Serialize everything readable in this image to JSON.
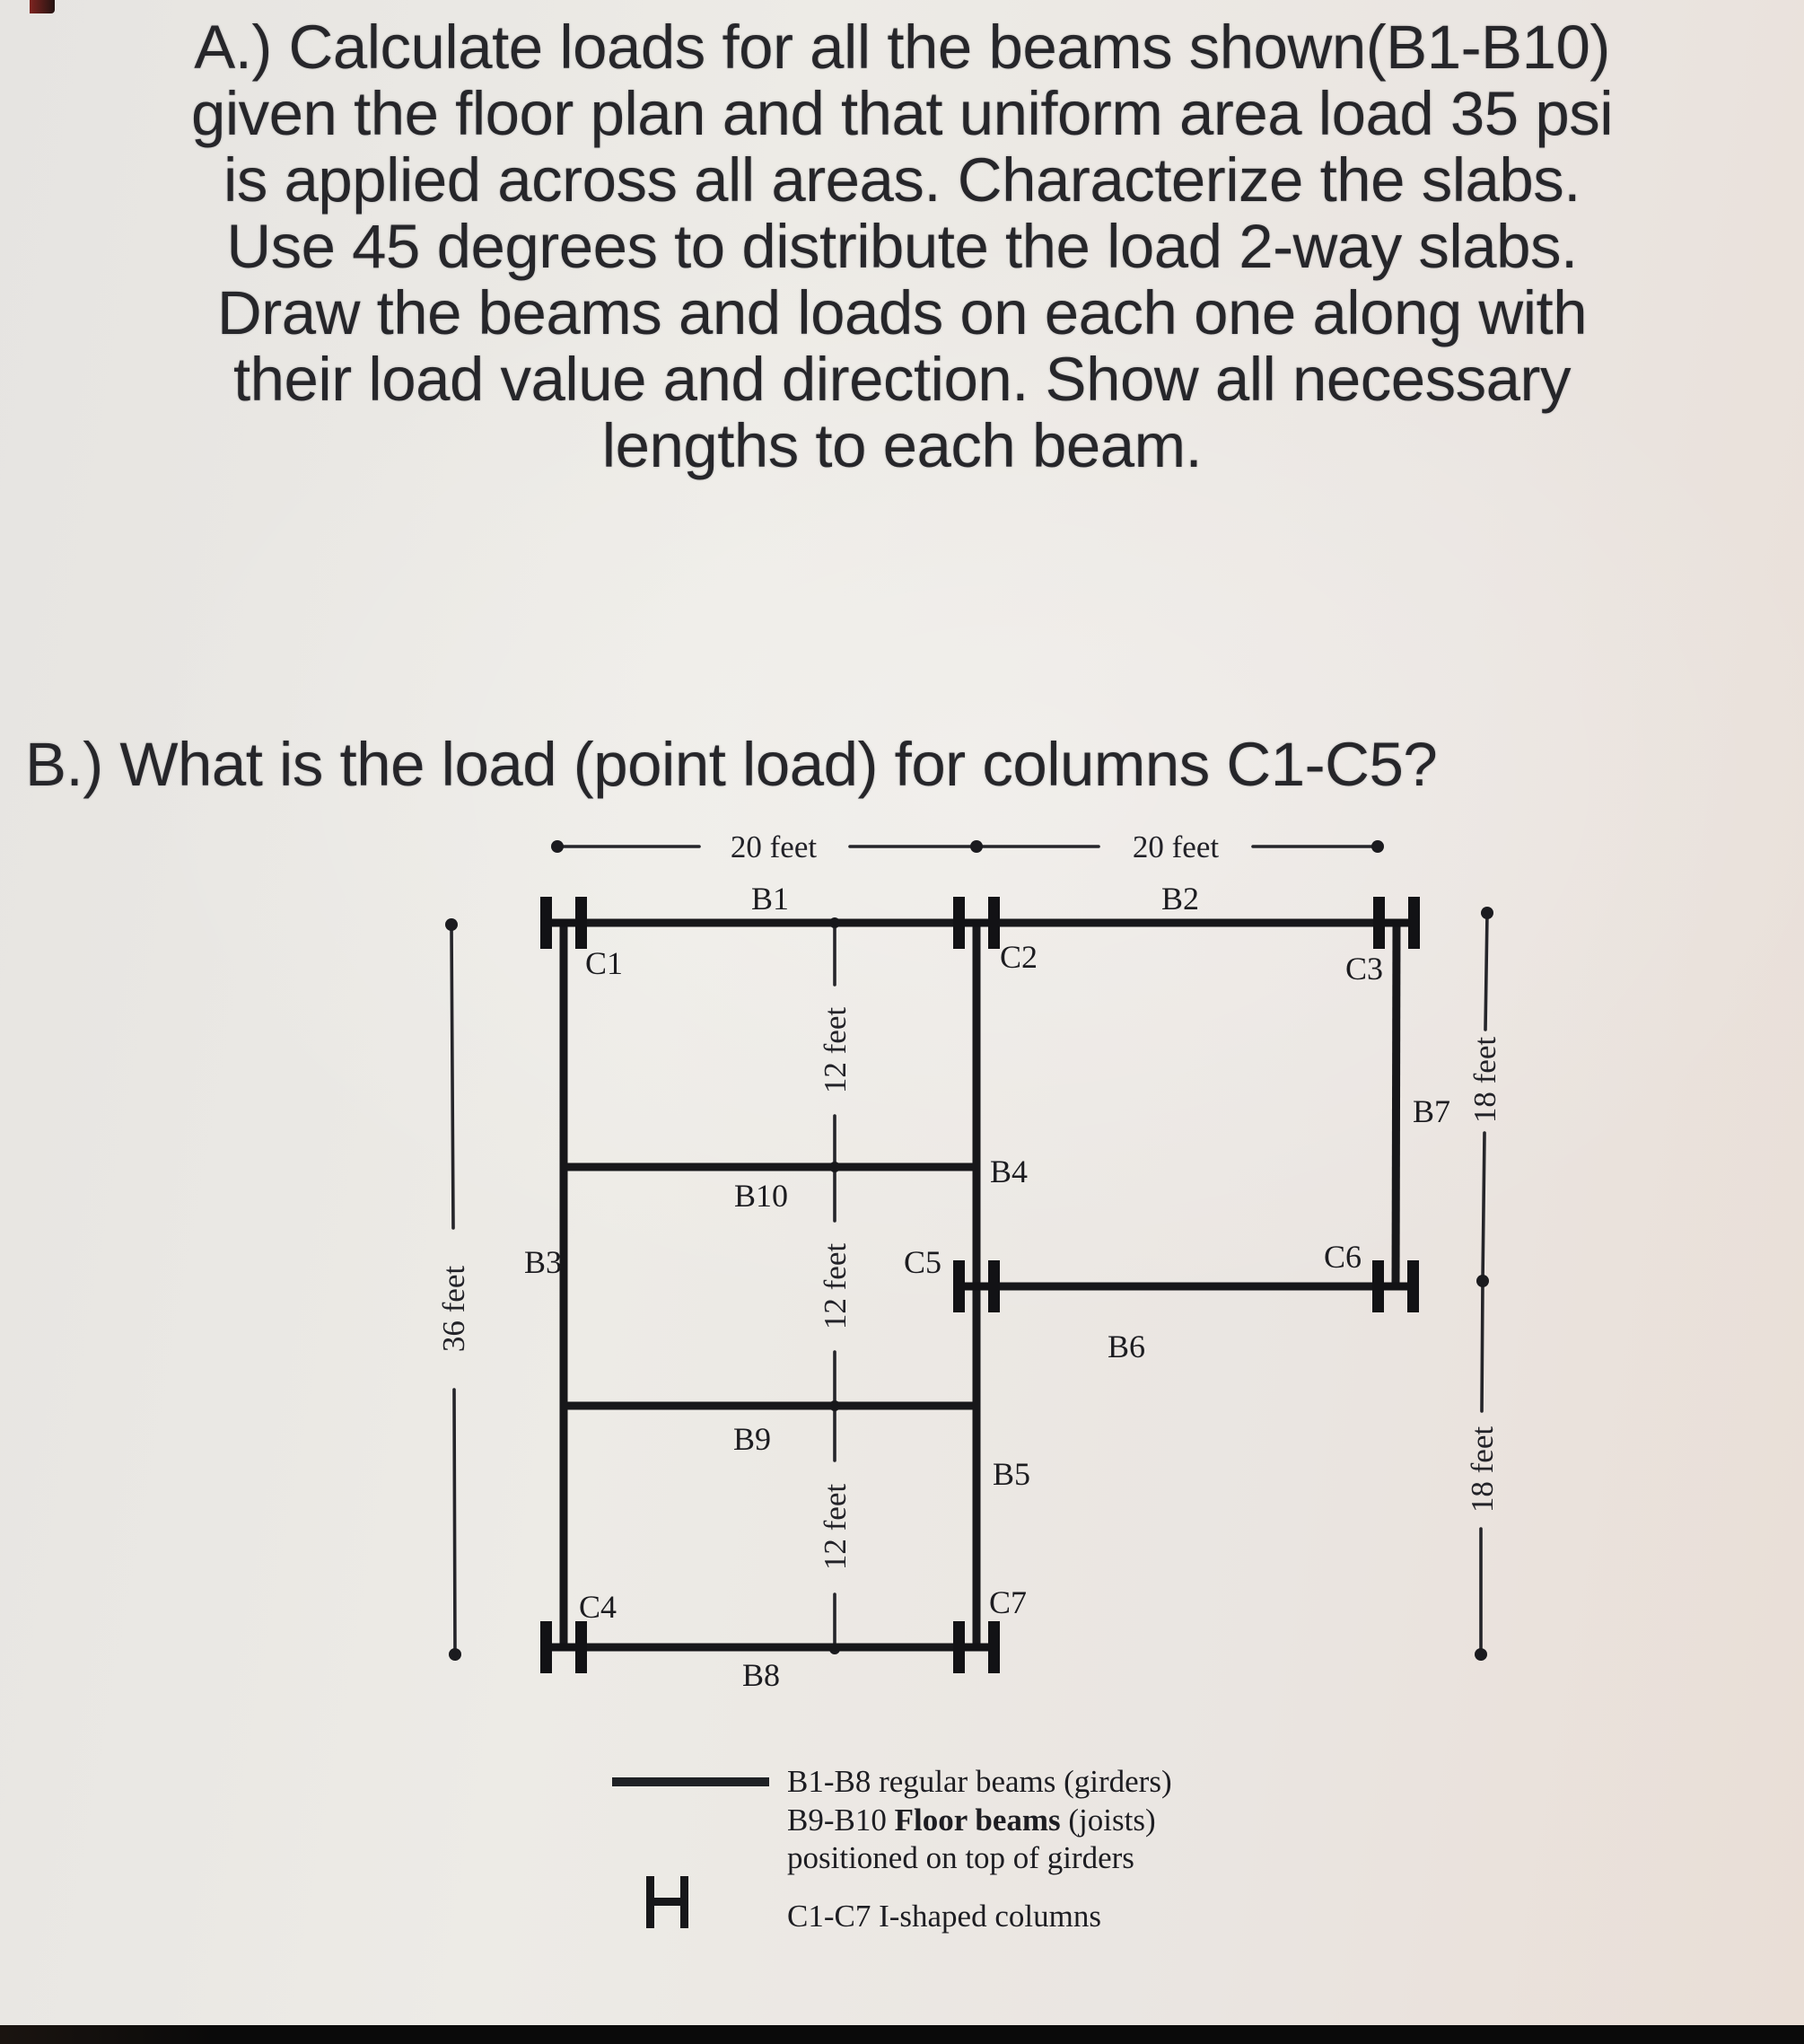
{
  "colors": {
    "ink": "#1b1b1f",
    "paper": "#eceae5"
  },
  "problem_a": {
    "lines": [
      "A.) Calculate loads for all the beams shown(B1-B10)",
      "given the floor plan and that uniform area load 35 psi",
      "is applied across all areas. Characterize the slabs.",
      "Use 45 degrees to distribute the load 2-way slabs.",
      "Draw the beams and loads on each one along with",
      "their load value and direction. Show all necessary",
      "lengths to each beam."
    ]
  },
  "problem_b": {
    "text": "B.) What is the load (point load) for columns C1-C5?"
  },
  "diagram": {
    "dims": {
      "top_left": "20 feet",
      "top_right": "20 feet",
      "left": "36 feet",
      "mid_1": "12 feet",
      "mid_2": "12 feet",
      "mid_3": "12 feet",
      "right_1": "18 feet",
      "right_2": "18 feet"
    },
    "beams": {
      "b1": "B1",
      "b2": "B2",
      "b3": "B3",
      "b4": "B4",
      "b5": "B5",
      "b6": "B6",
      "b7": "B7",
      "b8": "B8",
      "b9": "B9",
      "b10": "B10"
    },
    "columns": {
      "c1": "C1",
      "c2": "C2",
      "c3": "C3",
      "c4": "C4",
      "c5": "C5",
      "c6": "C6",
      "c7": "C7"
    }
  },
  "legend": {
    "beams_line": "B1-B8 regular beams (girders)",
    "joists_prefix": "B9-B10 ",
    "joists_bold": "Floor beams",
    "joists_suffix": " (joists)",
    "joists_line3": "positioned on top of girders",
    "columns_line": "C1-C7 I-shaped columns"
  }
}
